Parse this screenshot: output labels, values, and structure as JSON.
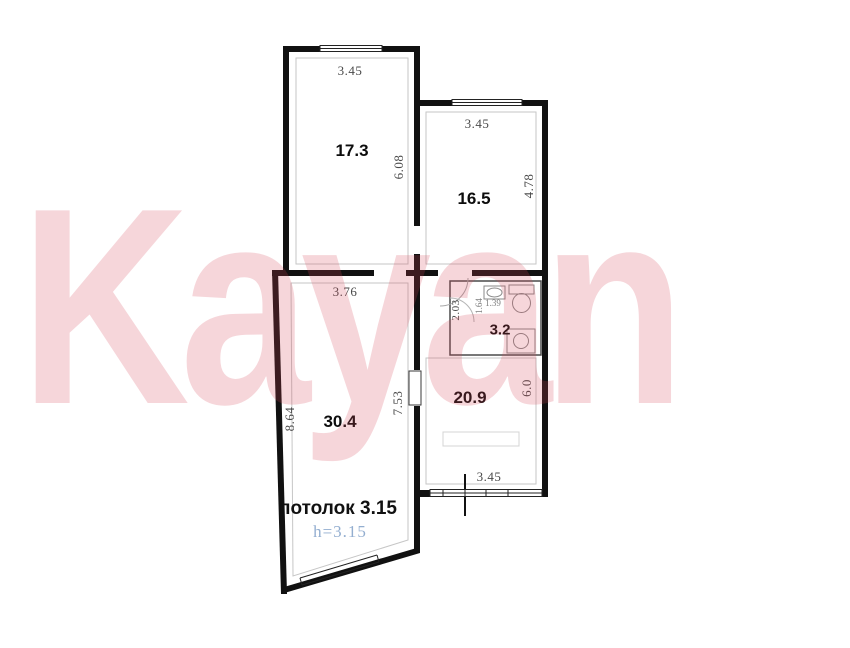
{
  "watermark": {
    "text": "Kayan",
    "color": "#d84658"
  },
  "plan": {
    "topLeft": {
      "area": "17.3",
      "dim_top": "3.45",
      "dim_right": "6.08"
    },
    "topRight": {
      "area": "16.5",
      "dim_top": "3.45",
      "dim_right": "4.78"
    },
    "bottomLeft": {
      "area": "30.4",
      "dim_top": "3.76",
      "dim_left": "8.64",
      "dim_right": "7.53",
      "ceiling_label": "потолок 3.15",
      "height_label": "h=3.15"
    },
    "hall": {
      "area": "20.9",
      "dim_right": "6.0",
      "dim_bottom": "3.45"
    },
    "bath": {
      "area": "3.2",
      "dim_left": "2.03",
      "dim_inner_a": "1.64",
      "dim_inner_b": "1.39"
    }
  },
  "colors": {
    "wall": "#111111",
    "dimension_text": "#4a4a4a",
    "area_text": "#0d0d0d",
    "height_note_text": "#93aed0",
    "watermark_pink": "rgba(216,70,88,0.22)"
  }
}
